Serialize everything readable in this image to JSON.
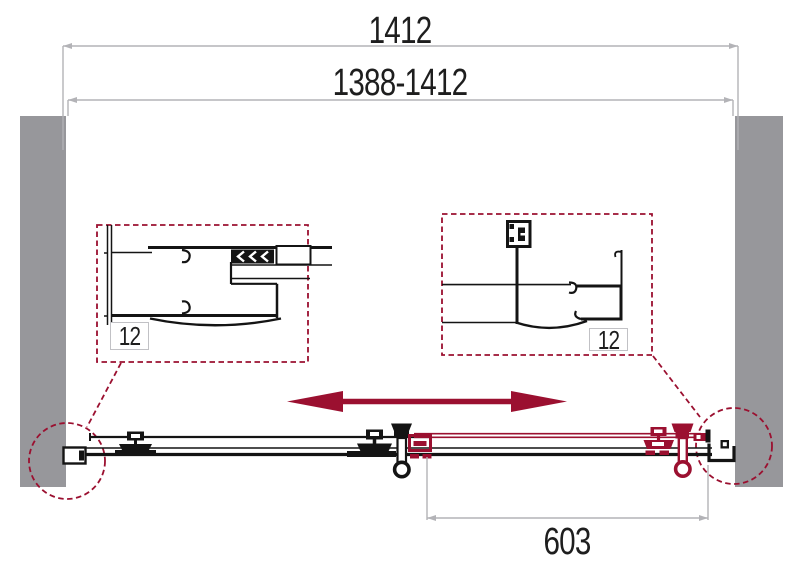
{
  "diagram": {
    "dimensions": {
      "overall_width": "1412",
      "adjustable_width_range": "1388-1412",
      "door_panel_width": "603"
    },
    "detail_callouts": {
      "left_profile_adjustment": "12",
      "right_profile_adjustment": "12"
    },
    "icons": {
      "slide_direction_arrow": "double-headed-horizontal-arrow"
    },
    "colors": {
      "accent": "#9B1030",
      "wall": "#97979B",
      "dimension_line": "#B3B3B7",
      "ink": "#141414",
      "background": "#FFFFFF",
      "label_box_border": "#C1C1C5"
    }
  }
}
